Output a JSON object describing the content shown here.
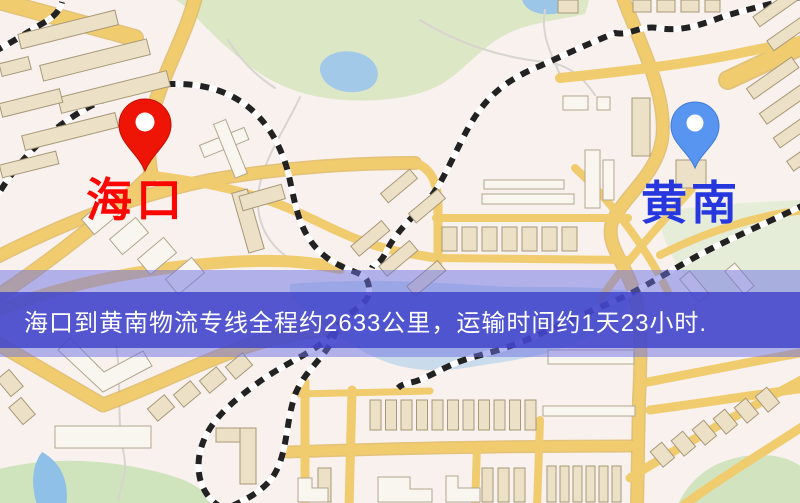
{
  "map": {
    "origin": {
      "label": "海口",
      "pin_color": "#ee1506",
      "label_color": "#fb0600"
    },
    "destination": {
      "label": "黄南",
      "pin_color": "#5795f0",
      "label_color": "#2737de"
    },
    "banner": {
      "text": "海口到黄南物流专线全程约2633公里，运输时间约1天23小时.",
      "text_color": "#ffffff",
      "overlay_core_color": "#3e42c9",
      "overlay_halo_color": "#6c70e4"
    },
    "palette": {
      "background": "#f8f1ee",
      "road": "#f0cc6e",
      "road_casing": "#dcb152",
      "park": "#dce7c6",
      "water": "#a3c9e9",
      "railway": "#222222",
      "building": "#ece0c6"
    }
  }
}
